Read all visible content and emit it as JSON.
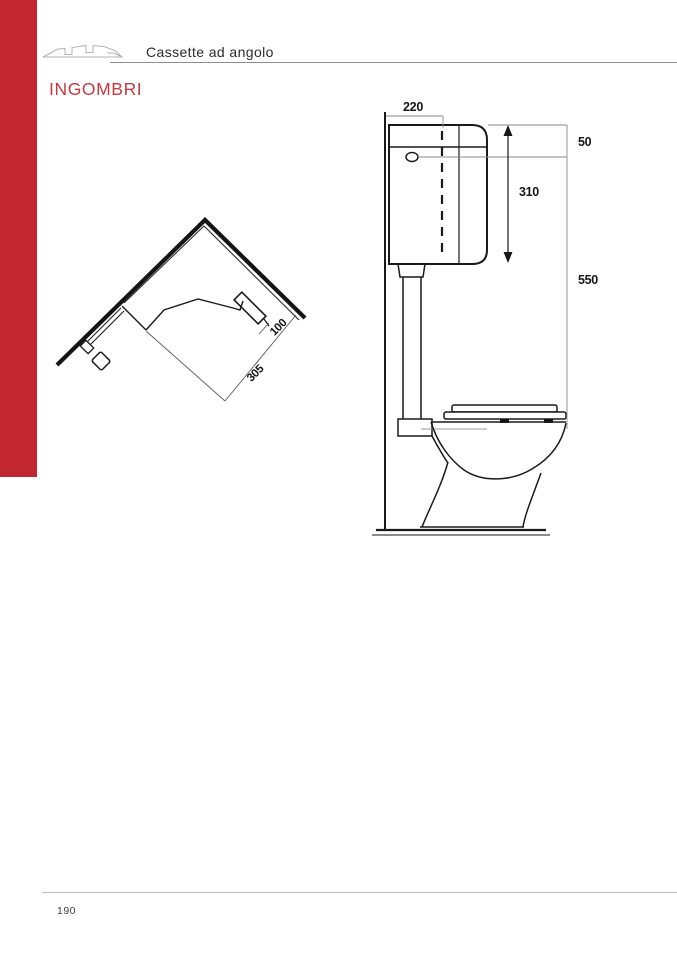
{
  "header": {
    "title": "Cassette ad angolo"
  },
  "section_title": "INGOMBRI",
  "page_number": "190",
  "colors": {
    "accent_bar": "#C22731",
    "section_title_red": "#C43A40",
    "header_rule_gray": "#8F8F8F",
    "footer_rule_gray": "#BDBDBD",
    "drawing_ink": "#1A1A1A",
    "dim_line_gray": "#8A8A8A"
  },
  "plan_view": {
    "dims": {
      "band_width": "100",
      "diagonal_depth": "305"
    }
  },
  "side_view": {
    "dims": {
      "cistern_width": "220",
      "lid_height": "50",
      "cistern_height": "310",
      "total_height": "550"
    }
  }
}
